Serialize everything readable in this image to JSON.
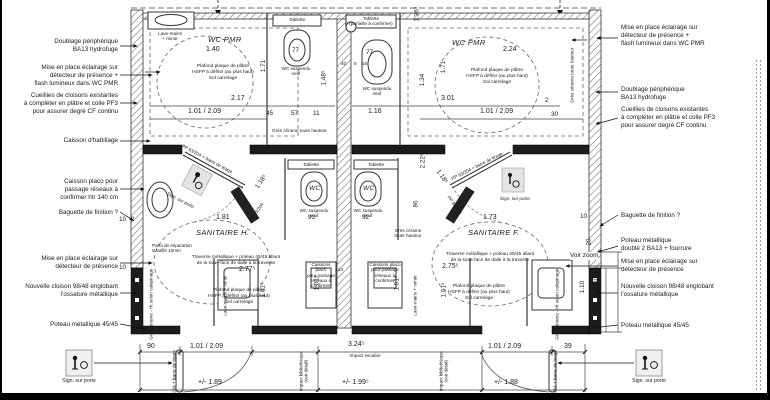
{
  "annotations": {
    "left": [
      {
        "text": "Doublage périphérique\nBA13 hydrofuge"
      },
      {
        "text": "Mise en place éclairage sur\ndétecteur de présence +\nflash lumineux dans WC PMR"
      },
      {
        "text": "Cueillies de cloisons existantes\nà compléter en plâtre et colle PF3\npour assurer degré CF continu"
      },
      {
        "text": "Caisson d'habillage"
      },
      {
        "text": "Caisson placo pour\npassage réseaux à\nconfirmer htr 140 cm"
      },
      {
        "text": "Baguette de finition ?"
      },
      {
        "text": "Mise en place éclairage sur\ndétecteur de présence"
      },
      {
        "text": "Nouvelle cloison 98/48 englobant\nl'ossature métallique"
      },
      {
        "text": "Poteau métallique 45/45"
      }
    ],
    "right": [
      {
        "text": "Mise en place éclairage sur\ndétecteur de présence +\nflash lumineux dans WC PMR"
      },
      {
        "text": "Doublage périphérique\nBA13 hydrofuge"
      },
      {
        "text": "Cueillies de cloisons existantes\nà compléter en plâtre et colle PF3\npour assurer degré CF continu"
      },
      {
        "text": "Baguette de finition ?"
      },
      {
        "text": "Poteau métallique\ndoublé 2 BA13 + fourrure"
      },
      {
        "text": "Mise en place éclairage sur\ndétecteur de présence"
      },
      {
        "text": "Nouvelle cloison 98/48 englobant\nl'ossature métallique"
      },
      {
        "text": "Poteau métallique 45/45"
      }
    ]
  },
  "t": {
    "wc_pmr": "WC PMR",
    "san_h": "SANITAIRE H.",
    "san_f": "SANITAIRE F.",
    "ceiling": "Plafond plaque de plâtre\nHSFP à définir (au plus haut)\nSol carrelage",
    "tablette": "Tablette",
    "tablette_p": "Tablette\n(partielle à confirmer)",
    "lave": "Lave-mains\n+ miroir",
    "lave_v": "Lave-mains + miroir",
    "wc_susp": "WC suspendu\nneuf",
    "wc": "WC",
    "paroi": "Paroi de séparation\nstratifié 10mm",
    "traverse": "Traverse métallique + poteau 45/45 allant\nde la sous-face de dalle à la traverse",
    "gres_th": "Grès cérame toute hauteur",
    "gres_th2": "Grès cérame\ntoute hauteur",
    "gres_cal": "Grès cérame - Ht selon calepinage",
    "pp93": "PP 93/204 + barre de tirage",
    "pp83": "PP 83/204",
    "caisson": "Caissons placo\npour passage\nréseaux à confirmer",
    "sign": "Sign. sur porte",
    "voir_zoom": "Voir zoom",
    "impact_esc": "Impact escalier",
    "impact_bib": "Impact bibliothèque\n(voir détail)"
  },
  "d": {
    "v140": "1.40",
    "v217": "2.17",
    "v224": "2.24",
    "v301": "3.01",
    "v116": "1.16",
    "door": "1.01 / 2.09",
    "v181": "1.81",
    "v173": "1.73",
    "v277": "2.77⁵",
    "v275": "2.75⁵",
    "v77": "77",
    "v93": "93",
    "v92": "92",
    "v171": "1.71",
    "v134": "1.34",
    "v136": "1.36⁵",
    "v148": "1.48⁵",
    "v222": "2.22⁵",
    "v86": "86",
    "v118": "1.18⁵",
    "v45": "45",
    "v57": "57",
    "v11": "11",
    "v40": "40",
    "v8": "8",
    "v18": "18",
    "v14": "14",
    "v90": "90",
    "v39": "39",
    "v324": "3.24⁵",
    "pm189": "+/- 1.89",
    "pm199": "+/- 1.99⁵",
    "pm188": "+/- 1.88",
    "v101": "1.01⁵",
    "v110": "1.10",
    "v130": "1.30",
    "v10": "10",
    "v2": "2",
    "v30": "30",
    "v20": "20"
  }
}
